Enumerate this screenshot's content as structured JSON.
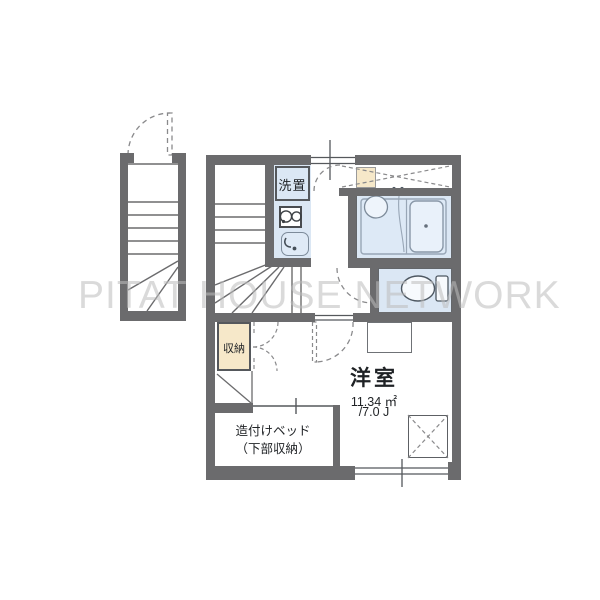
{
  "watermark": {
    "text": "PITAT HOUSE NETWORK"
  },
  "labels": {
    "laundry": "洗置",
    "storage": "収納",
    "bed_line1": "造付けベッド",
    "bed_line2": "（下部収納）",
    "room_name": "洋室",
    "room_area_m2": "11.34 ㎡",
    "room_area_jo": "/7.0 J"
  },
  "colors": {
    "wall_gray": "#6b6b6d",
    "water_blue": "#dbe7f4",
    "closet_tan": "#f6e8c9",
    "line_dark": "#55585c",
    "watermark_gray": "#bdbdbd"
  },
  "fixtures": [
    "external-staircase",
    "internal-staircase",
    "entrance-door",
    "laundry-space",
    "gas-stove",
    "kitchen-sink",
    "unit-bath",
    "bathtub",
    "wash-basin",
    "toilet",
    "storage-closet",
    "built-in-bed",
    "window",
    "equipment-space"
  ]
}
